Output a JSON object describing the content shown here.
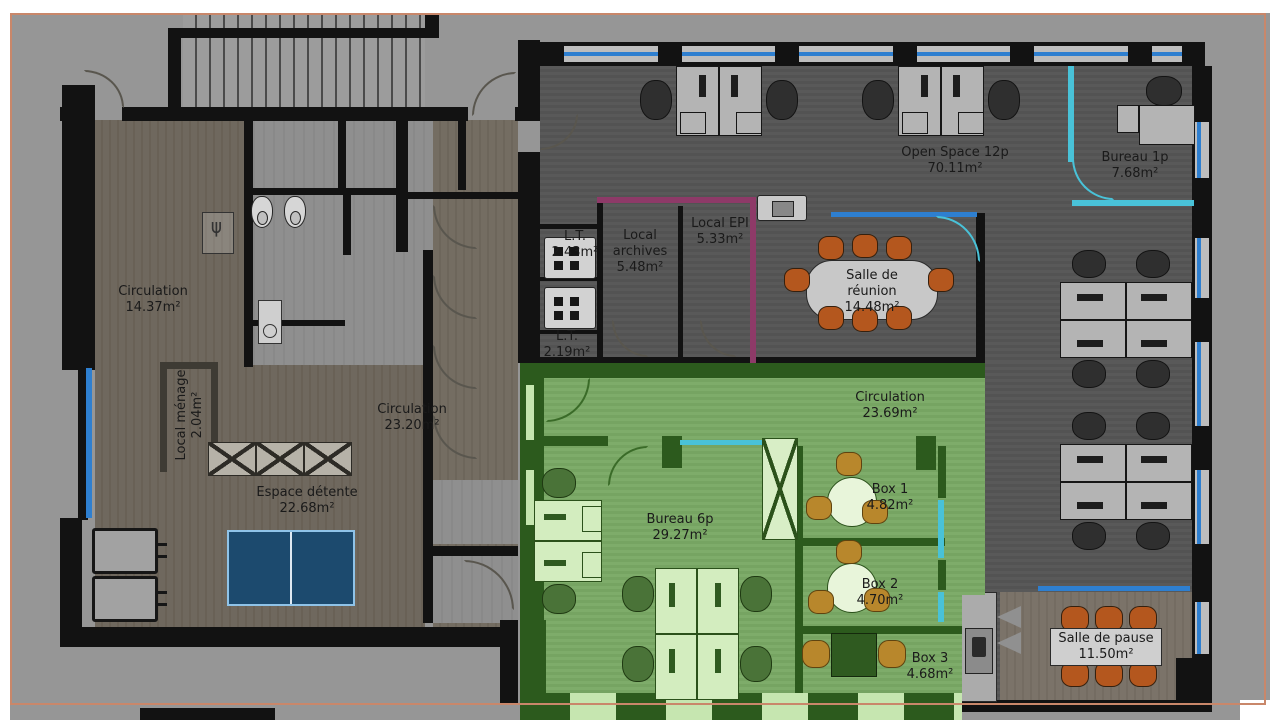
{
  "rooms": {
    "circulation_14": {
      "name": "Circulation",
      "area": "14.37m²"
    },
    "local_menage": {
      "name": "Local ménage",
      "area": "2.04m²"
    },
    "circulation_23_20": {
      "name": "Circulation",
      "area": "23.20m²"
    },
    "espace_detente": {
      "name": "Espace détente",
      "area": "22.68m²"
    },
    "lt_1": {
      "name": "L.T.",
      "area": "2.43m²"
    },
    "lt_2": {
      "name": "L.T.",
      "area": "2.19m²"
    },
    "local_archives": {
      "name": "Local archives",
      "area": "5.48m²"
    },
    "local_epi": {
      "name": "Local EPI",
      "area": "5.33m²"
    },
    "open_space": {
      "name": "Open Space 12p",
      "area": "70.11m²"
    },
    "salle_reunion": {
      "name": "Salle de réunion",
      "area": "14.48m²"
    },
    "bureau_1p": {
      "name": "Bureau 1p",
      "area": "7.68m²"
    },
    "circulation_23_69": {
      "name": "Circulation",
      "area": "23.69m²"
    },
    "bureau_6p": {
      "name": "Bureau 6p",
      "area": "29.27m²"
    },
    "box_1": {
      "name": "Box 1",
      "area": "4.82m²"
    },
    "box_2": {
      "name": "Box 2",
      "area": "4.70m²"
    },
    "box_3": {
      "name": "Box 3",
      "area": "4.68m²"
    },
    "salle_pause": {
      "name": "Salle de pause",
      "area": "11.50m²"
    }
  },
  "palette": {
    "highlight_green": "#7cab68",
    "zone_wall_green": "#2c5a1d",
    "window_blue": "#2e7fd0",
    "partition_cyan": "#49c2d8",
    "chair_orange": "#b4571e",
    "chair_amber": "#b8872c",
    "wall_magenta": "#8e3a68",
    "frame_orange": "#c9876a",
    "pingpong_blue": "#1c4a6e"
  }
}
